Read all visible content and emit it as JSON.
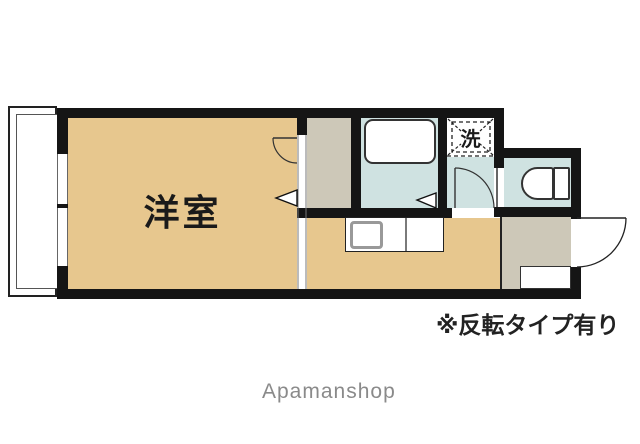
{
  "floorplan": {
    "labels": {
      "western_room": "洋室",
      "washer": "洗"
    },
    "annotation": "※反転タイプ有り",
    "watermark": "Apamanshop",
    "colors": {
      "room_floor": "#e7c78e",
      "wet_area_floor": "#cfe2e1",
      "entrance_closet_floor": "#cdc8b8",
      "wall": "#151515",
      "annotation_text": "#222222",
      "watermark_text": "#8a8a8a"
    },
    "rooms": [
      {
        "name": "balcony"
      },
      {
        "name": "western_room",
        "label": "洋室"
      },
      {
        "name": "closet"
      },
      {
        "name": "bathroom"
      },
      {
        "name": "washer_space",
        "label": "洗"
      },
      {
        "name": "hallway"
      },
      {
        "name": "toilet"
      },
      {
        "name": "kitchen"
      },
      {
        "name": "entrance"
      }
    ]
  }
}
